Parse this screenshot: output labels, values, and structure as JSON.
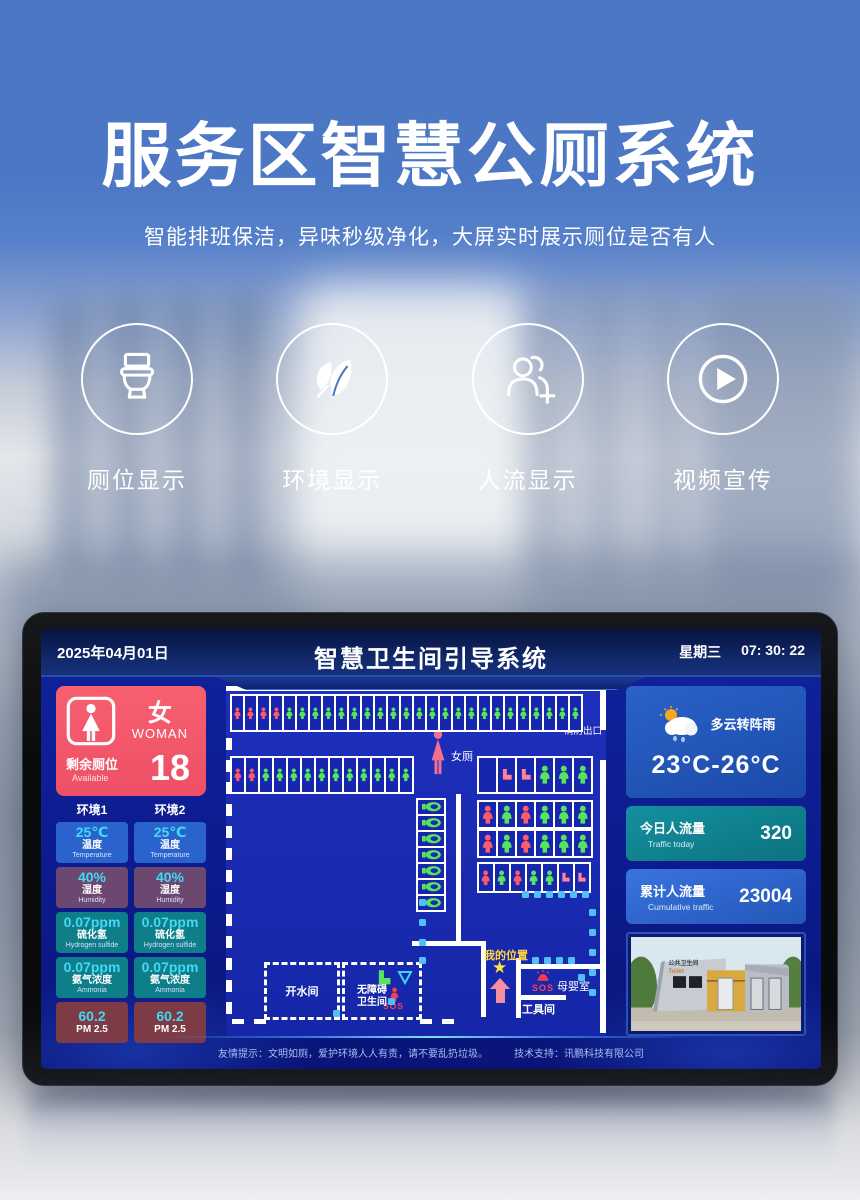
{
  "hero": {
    "title": "服务区智慧公厕系统",
    "subtitle": "智能排班保洁，异味秒级净化，大屏实时展示厕位是否有人",
    "features": [
      {
        "icon": "toilet-icon",
        "label": "厕位显示"
      },
      {
        "icon": "leaf-icon",
        "label": "环境显示"
      },
      {
        "icon": "people-plus-icon",
        "label": "人流显示"
      },
      {
        "icon": "play-icon",
        "label": "视频宣传"
      }
    ]
  },
  "screen": {
    "header": {
      "date": "2025年04月01日",
      "title": "智慧卫生间引导系统",
      "weekday": "星期三",
      "time": "07: 30: 22"
    },
    "left_panel": {
      "gender_cn": "女",
      "gender_en": "WOMAN",
      "remain_cn": "剩余厕位",
      "remain_en": "Available",
      "remain_value": "18",
      "env_headers": [
        "环境1",
        "环境2"
      ],
      "value_color": "#41d9f7",
      "metrics": [
        {
          "value": "25℃",
          "cn": "温度",
          "en": "Temperature",
          "color": "#2b63cd"
        },
        {
          "value": "40%",
          "cn": "湿度",
          "en": "Humidity",
          "color": "#6c4871"
        },
        {
          "value": "0.07ppm",
          "cn": "硫化氢",
          "en": "Hydrogen sulfide",
          "color": "#0e7e88"
        },
        {
          "value": "0.07ppm",
          "cn": "氨气浓度",
          "en": "Ammonia",
          "color": "#0e7e88"
        },
        {
          "value": "60.2",
          "cn": "PM 2.5",
          "en": "",
          "color": "#7d3b46"
        }
      ]
    },
    "map": {
      "labels": {
        "women_area": "女厕",
        "fire_exit": "消防出口",
        "my_location": "我的位置",
        "mother_baby": "母婴室",
        "tool_room": "工具间",
        "hot_water": "开水间",
        "accessible_1": "无障碍",
        "accessible_2": "卫生间",
        "sos": "SOS"
      },
      "status_colors": {
        "occupied": "#ff5a68",
        "vacant": "#57e35b",
        "squat": "#ff8294"
      },
      "stall_rows": {
        "top": [
          "r",
          "r",
          "r",
          "r",
          "g",
          "g",
          "g",
          "g",
          "g",
          "g",
          "g",
          "g",
          "g",
          "g",
          "g",
          "g",
          "g",
          "g",
          "g",
          "g",
          "g",
          "g",
          "g",
          "g",
          "g",
          "g",
          "g"
        ],
        "row2": [
          "r",
          "r",
          "g",
          "g",
          "g",
          "g",
          "g",
          "g",
          "g",
          "g",
          "g",
          "g",
          "g"
        ],
        "urinals": [
          "u",
          "u",
          "u",
          "u",
          "u",
          "u",
          "u"
        ],
        "rowA": [
          "e",
          "s",
          "s",
          "g",
          "g",
          "g"
        ],
        "block1": [
          "r",
          "g",
          "r",
          "g",
          "g",
          "g"
        ],
        "block2": [
          "r",
          "g",
          "r",
          "g",
          "g",
          "g"
        ],
        "rowD": [
          "r",
          "g",
          "r",
          "g",
          "g",
          "s",
          "s"
        ]
      }
    },
    "right_panel": {
      "weather": {
        "desc": "多云转阵雨",
        "range": "23°C-26°C"
      },
      "today": {
        "cn": "今日人流量",
        "en": "Traffic  today",
        "value": "320"
      },
      "cumulative": {
        "cn": "累计人流量",
        "en": "Cumulative traffic",
        "value": "23004"
      },
      "photo_caption_cn": "公共卫生间",
      "photo_caption_en": "Toilet"
    },
    "footer": {
      "tip": "友情提示：文明如厕，爱护环境人人有责，请不要乱扔垃圾。",
      "support": "技术支持：讯鹏科技有限公司"
    }
  }
}
